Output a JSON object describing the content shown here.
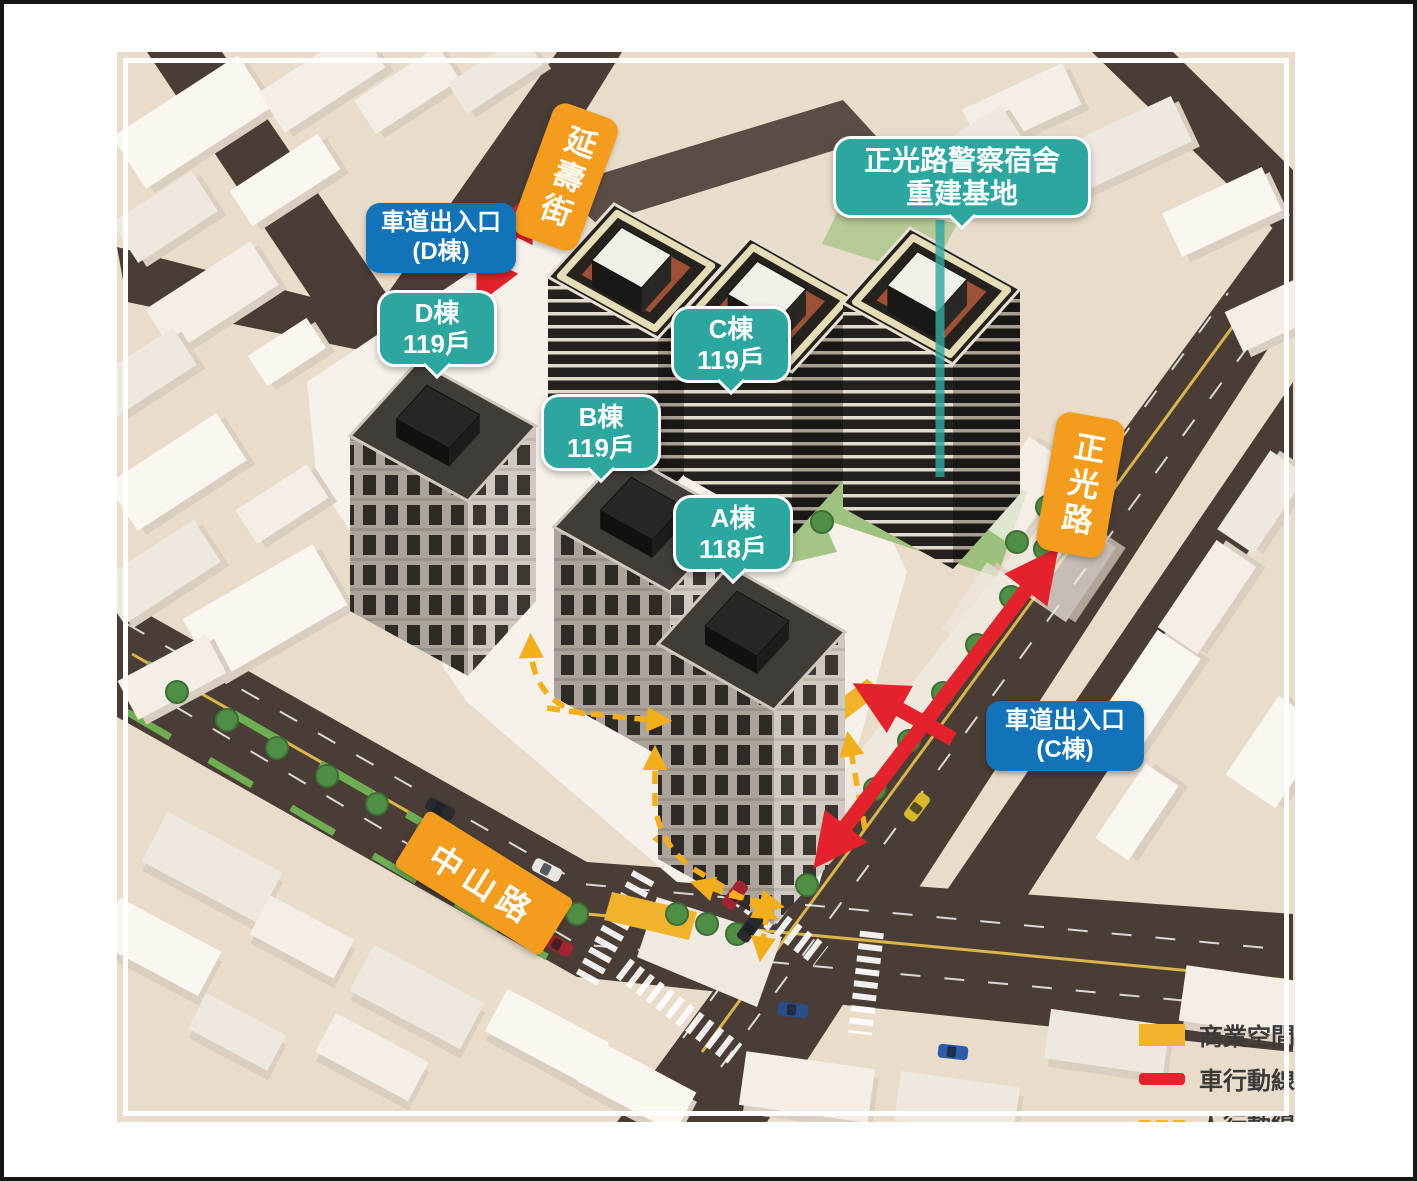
{
  "roads": {
    "yanshou": "延壽街",
    "zhengguang": "正光路",
    "zhongshan": "中山路"
  },
  "site_label": {
    "line1": "正光路警察宿舍",
    "line2": "重建基地"
  },
  "entrances": {
    "d": {
      "line1": "車道出入口",
      "line2": "(D棟)"
    },
    "c": {
      "line1": "車道出入口",
      "line2": "(C棟)"
    }
  },
  "towers": {
    "d": {
      "name": "D棟",
      "units": "119戶"
    },
    "c": {
      "name": "C棟",
      "units": "119戶"
    },
    "b": {
      "name": "B棟",
      "units": "119戶"
    },
    "a": {
      "name": "A棟",
      "units": "118戶"
    }
  },
  "legend": {
    "commercial": "商業空間",
    "vehicle": "車行動線",
    "pedestrian": "人行動線"
  },
  "colors": {
    "teal": "#2BA7A0",
    "blue": "#1273B9",
    "orange": "#F49D1D",
    "red": "#E3222B",
    "yellow": "#F0B32A"
  }
}
